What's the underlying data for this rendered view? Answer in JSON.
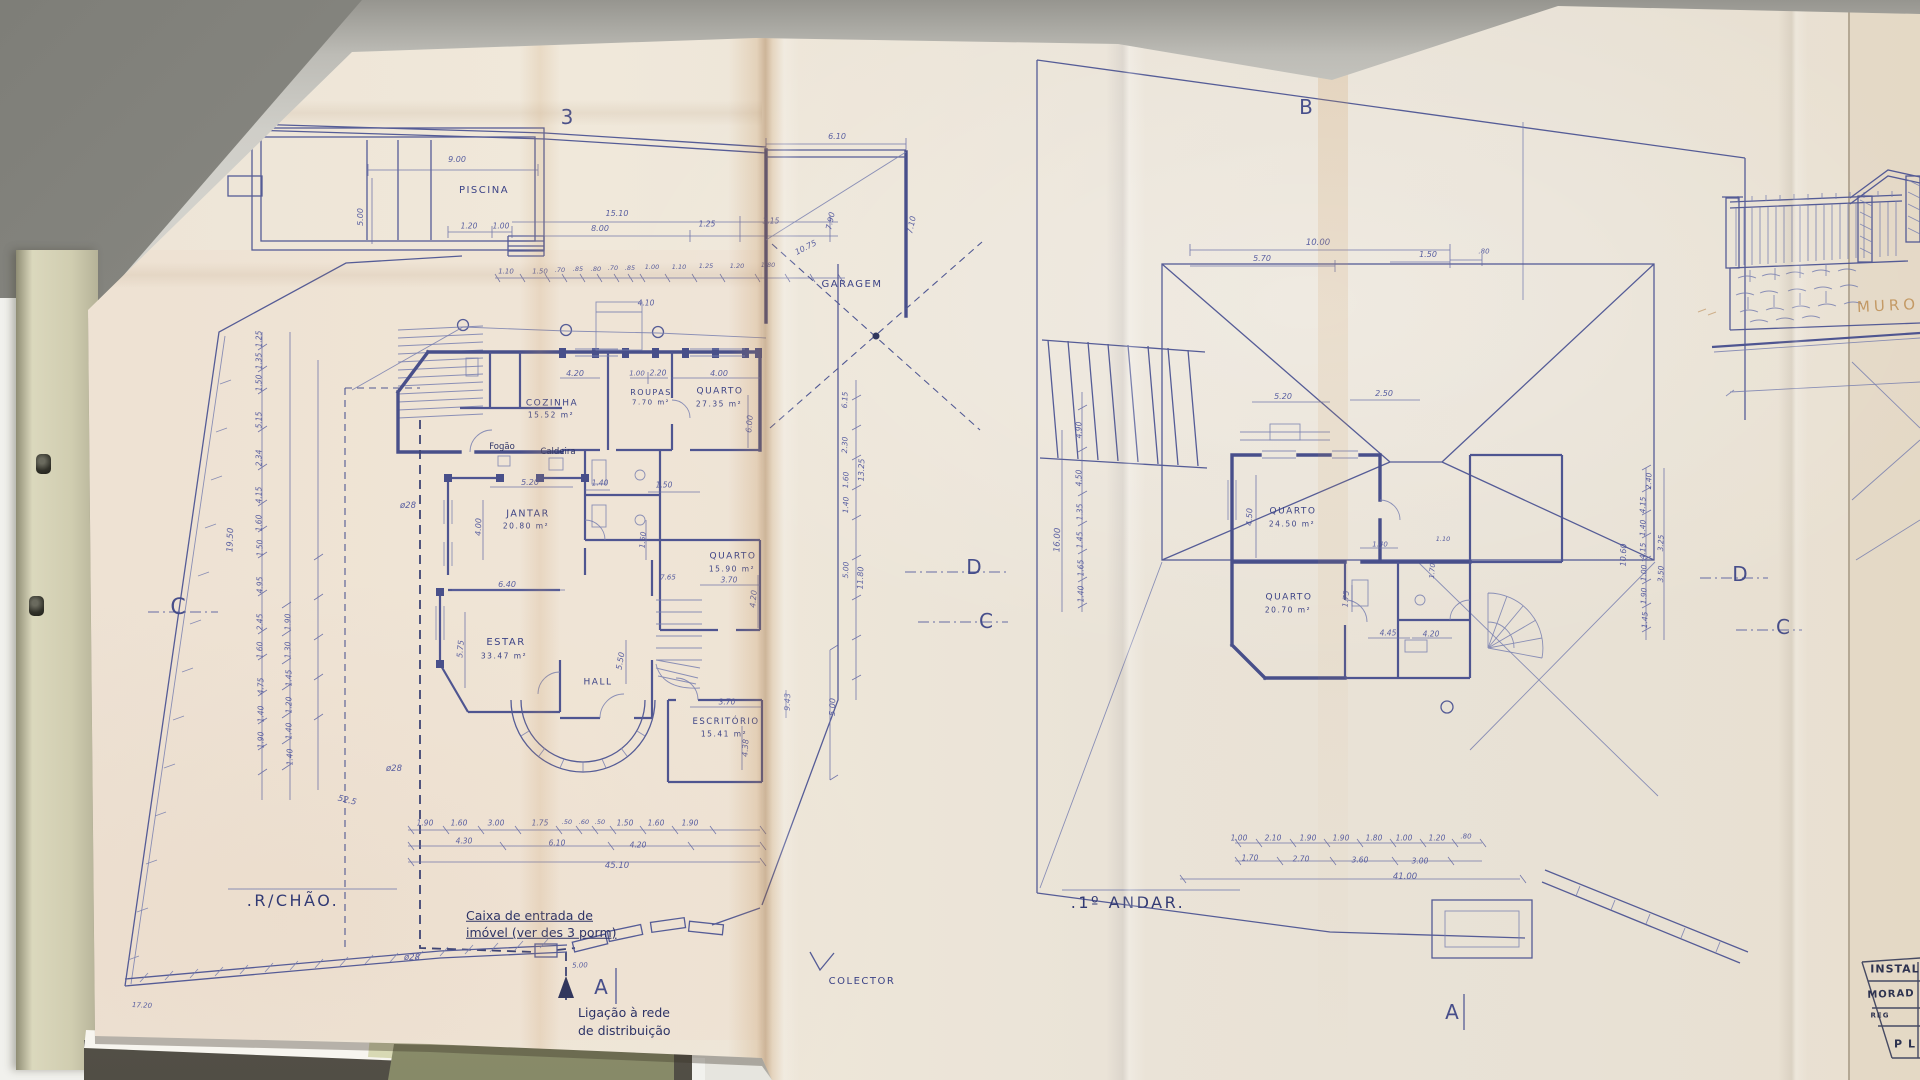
{
  "colors": {
    "ink": "#4a5292",
    "wall_ink": "#3c4485",
    "paper": "#ece4d6",
    "fold_tan": "#c08a50",
    "desk": "#d8d7d1",
    "folder": "#d0cdb0",
    "green_folder": "#989b76",
    "note_ink": "#2d3366",
    "pencil": "#bf9055"
  },
  "sheets": {
    "left_plan_title": ".R/CHÃO.",
    "right_plan_title": ".1º ANDAR.",
    "third_sheet": "title block + wall elevation (cut off)"
  },
  "labels": [
    {
      "n": "fold-number-3",
      "t": "3",
      "x": 567,
      "y": 117,
      "s": 20,
      "c": "big"
    },
    {
      "n": "section-letter-b",
      "t": "B",
      "x": 1306,
      "y": 107,
      "s": 20,
      "c": "big"
    },
    {
      "n": "section-letter-c-left",
      "t": "C",
      "x": 178,
      "y": 608,
      "s": 22,
      "c": "big"
    },
    {
      "n": "section-letter-d-mid",
      "t": "D",
      "x": 974,
      "y": 567,
      "s": 20,
      "c": "big"
    },
    {
      "n": "section-letter-c-mid",
      "t": "C",
      "x": 986,
      "y": 621,
      "s": 20,
      "c": "big"
    },
    {
      "n": "section-letter-d-right",
      "t": "D",
      "x": 1740,
      "y": 574,
      "s": 20,
      "c": "big"
    },
    {
      "n": "section-letter-c-right",
      "t": "C",
      "x": 1783,
      "y": 627,
      "s": 20,
      "c": "big"
    },
    {
      "n": "section-letter-a-left",
      "t": "A",
      "x": 601,
      "y": 987,
      "s": 20,
      "c": "big"
    },
    {
      "n": "section-letter-a-right",
      "t": "A",
      "x": 1452,
      "y": 1012,
      "s": 20,
      "c": "big"
    },
    {
      "n": "plan-title-ground-floor",
      "t": ".R/CHÃO.",
      "x": 293,
      "y": 901,
      "s": 16,
      "c": "title"
    },
    {
      "n": "plan-title-first-floor",
      "t": ".1º ANDAR.",
      "x": 1128,
      "y": 903,
      "s": 16,
      "c": "title"
    },
    {
      "n": "room-piscina",
      "t": "PISCINA",
      "x": 484,
      "y": 191,
      "s": 10,
      "c": "room"
    },
    {
      "n": "room-garagem",
      "t": "GARAGEM",
      "x": 852,
      "y": 285,
      "s": 10,
      "c": "room"
    },
    {
      "n": "room-cozinha",
      "t": "COZINHA",
      "x": 552,
      "y": 404,
      "s": 9,
      "c": "room"
    },
    {
      "n": "room-cozinha-area",
      "t": "15.52 m²",
      "x": 551,
      "y": 415,
      "s": 7.5,
      "c": "room"
    },
    {
      "n": "label-fogao",
      "t": "Fogão",
      "x": 502,
      "y": 447,
      "s": 8.5,
      "c": "note"
    },
    {
      "n": "label-caldeira",
      "t": "Caldeira",
      "x": 558,
      "y": 452,
      "s": 8.5,
      "c": "note"
    },
    {
      "n": "room-roupas",
      "t": "ROUPAS",
      "x": 651,
      "y": 393,
      "s": 8,
      "c": "room"
    },
    {
      "n": "room-roupas-area",
      "t": "7.70 m²",
      "x": 651,
      "y": 403,
      "s": 7,
      "c": "room"
    },
    {
      "n": "room-quarto-1",
      "t": "QUARTO",
      "x": 720,
      "y": 392,
      "s": 9,
      "c": "room"
    },
    {
      "n": "room-quarto-1-area",
      "t": "27.35 m²",
      "x": 719,
      "y": 404,
      "s": 7.5,
      "c": "room"
    },
    {
      "n": "room-jantar",
      "t": "JANTAR",
      "x": 528,
      "y": 514,
      "s": 9.5,
      "c": "room"
    },
    {
      "n": "room-jantar-area",
      "t": "20.80 m²",
      "x": 526,
      "y": 526,
      "s": 7.5,
      "c": "room"
    },
    {
      "n": "room-estar",
      "t": "ESTAR",
      "x": 506,
      "y": 643,
      "s": 10,
      "c": "room"
    },
    {
      "n": "room-estar-area",
      "t": "33.47 m²",
      "x": 504,
      "y": 656,
      "s": 7.5,
      "c": "room"
    },
    {
      "n": "room-hall",
      "t": "HALL",
      "x": 598,
      "y": 683,
      "s": 9,
      "c": "room"
    },
    {
      "n": "room-quarto-2",
      "t": "QUARTO",
      "x": 733,
      "y": 557,
      "s": 9,
      "c": "room"
    },
    {
      "n": "room-quarto-2-area",
      "t": "15.90 m²",
      "x": 732,
      "y": 569,
      "s": 7.5,
      "c": "room"
    },
    {
      "n": "room-escritorio",
      "t": "ESCRITÓRIO",
      "x": 726,
      "y": 722,
      "s": 8.5,
      "c": "room"
    },
    {
      "n": "room-escritorio-area",
      "t": "15.41 m²",
      "x": 724,
      "y": 734,
      "s": 7.5,
      "c": "room"
    },
    {
      "n": "room-ff-quarto-1",
      "t": "QUARTO",
      "x": 1293,
      "y": 512,
      "s": 9,
      "c": "room"
    },
    {
      "n": "room-ff-quarto-1-area",
      "t": "24.50 m²",
      "x": 1292,
      "y": 524,
      "s": 7.5,
      "c": "room"
    },
    {
      "n": "room-ff-quarto-2",
      "t": "QUARTO",
      "x": 1289,
      "y": 598,
      "s": 9,
      "c": "room"
    },
    {
      "n": "room-ff-quarto-2-area",
      "t": "20.70 m²",
      "x": 1288,
      "y": 610,
      "s": 7.5,
      "c": "room"
    },
    {
      "n": "label-colector",
      "t": "COLECTOR",
      "x": 862,
      "y": 982,
      "s": 10,
      "c": "room"
    },
    {
      "n": "note-caixa-line1",
      "t": "Caixa de entrada de",
      "x": 466,
      "y": 916,
      "s": 12.5,
      "c": "note",
      "a": "l",
      "u": 1
    },
    {
      "n": "note-caixa-line2",
      "t": "imóvel (ver des 3 porm)",
      "x": 466,
      "y": 933,
      "s": 12.5,
      "c": "note",
      "a": "l",
      "u": 1
    },
    {
      "n": "note-ligacao-line1",
      "t": "Ligação à rede",
      "x": 578,
      "y": 1013,
      "s": 12.5,
      "c": "note",
      "a": "l"
    },
    {
      "n": "note-ligacao-line2",
      "t": "de distribuição",
      "x": 578,
      "y": 1031,
      "s": 12.5,
      "c": "note",
      "a": "l"
    },
    {
      "n": "label-muro",
      "t": "MURO",
      "x": 1888,
      "y": 306,
      "s": 15,
      "c": "pencil",
      "r": -3,
      "ls": 4
    },
    {
      "n": "title-block-instal",
      "t": "INSTAL",
      "x": 1895,
      "y": 969,
      "s": 11,
      "c": "tb"
    },
    {
      "n": "title-block-morad",
      "t": "MORAD",
      "x": 1891,
      "y": 995,
      "s": 10,
      "c": "tb",
      "r": -2
    },
    {
      "n": "title-block-reg",
      "t": "REG",
      "x": 1880,
      "y": 1016,
      "s": 7,
      "c": "tb"
    },
    {
      "n": "title-block-pl",
      "t": "P L",
      "x": 1905,
      "y": 1044,
      "s": 11,
      "c": "tb"
    },
    {
      "n": "pipe-diameter",
      "t": "ø28",
      "x": 408,
      "y": 506,
      "s": 8.5
    },
    {
      "n": "pipe-diameter",
      "t": "ø28",
      "x": 394,
      "y": 769,
      "s": 8.5
    },
    {
      "n": "pipe-diameter",
      "t": "ø28",
      "x": 412,
      "y": 958,
      "s": 8.5
    },
    {
      "t": "52.5",
      "x": 347,
      "y": 801,
      "s": 8.5,
      "r": 14
    },
    {
      "t": "17.20",
      "x": 142,
      "y": 1006,
      "s": 7,
      "r": 3
    },
    {
      "t": "5.00",
      "x": 580,
      "y": 966,
      "s": 7,
      "r": -2
    },
    {
      "t": "9.00",
      "x": 457,
      "y": 160,
      "s": 8
    },
    {
      "t": "5.00",
      "x": 361,
      "y": 217,
      "s": 8,
      "r": -90
    },
    {
      "t": "1.20",
      "x": 469,
      "y": 226,
      "s": 7.5
    },
    {
      "t": "1.00",
      "x": 501,
      "y": 226,
      "s": 7.5
    },
    {
      "t": "15.10",
      "x": 617,
      "y": 214,
      "s": 8
    },
    {
      "t": "8.00",
      "x": 600,
      "y": 229,
      "s": 8
    },
    {
      "t": "1.25",
      "x": 707,
      "y": 224,
      "s": 7.5
    },
    {
      "t": "3.15",
      "x": 771,
      "y": 221,
      "s": 7.5
    },
    {
      "t": "6.10",
      "x": 837,
      "y": 137,
      "s": 8
    },
    {
      "t": "1.10",
      "x": 506,
      "y": 272,
      "s": 7
    },
    {
      "t": "1.50",
      "x": 540,
      "y": 272,
      "s": 7
    },
    {
      "t": ".70",
      "x": 560,
      "y": 270,
      "s": 6.5
    },
    {
      "t": ".85",
      "x": 578,
      "y": 269,
      "s": 6.5
    },
    {
      "t": ".80",
      "x": 596,
      "y": 269,
      "s": 6.5
    },
    {
      "t": ".70",
      "x": 613,
      "y": 268,
      "s": 6.5
    },
    {
      "t": ".85",
      "x": 630,
      "y": 268,
      "s": 6.5
    },
    {
      "t": "1.00",
      "x": 652,
      "y": 267,
      "s": 6.5
    },
    {
      "t": "1.10",
      "x": 679,
      "y": 267,
      "s": 6.5
    },
    {
      "t": "1.25",
      "x": 706,
      "y": 266,
      "s": 6.5
    },
    {
      "t": "1.20",
      "x": 737,
      "y": 266,
      "s": 6.5
    },
    {
      "t": "1.80",
      "x": 768,
      "y": 265,
      "s": 6.5
    },
    {
      "t": "10.75",
      "x": 806,
      "y": 248,
      "s": 8,
      "r": -27
    },
    {
      "t": "7.90",
      "x": 831,
      "y": 221,
      "s": 8,
      "r": -78
    },
    {
      "t": "7.10",
      "x": 912,
      "y": 225,
      "s": 8,
      "r": -78
    },
    {
      "t": "4.10",
      "x": 646,
      "y": 303,
      "s": 7.5
    },
    {
      "t": "1.00",
      "x": 637,
      "y": 374,
      "s": 7
    },
    {
      "t": "2.20",
      "x": 658,
      "y": 373,
      "s": 7.5
    },
    {
      "t": "4.00",
      "x": 719,
      "y": 374,
      "s": 8
    },
    {
      "t": "6.00",
      "x": 750,
      "y": 424,
      "s": 8,
      "r": -85
    },
    {
      "t": "4.20",
      "x": 575,
      "y": 374,
      "s": 8
    },
    {
      "t": "5.20",
      "x": 530,
      "y": 483,
      "s": 8
    },
    {
      "t": "1.40",
      "x": 600,
      "y": 483,
      "s": 7.5
    },
    {
      "t": "1.50",
      "x": 664,
      "y": 485,
      "s": 7.5
    },
    {
      "t": "4.00",
      "x": 479,
      "y": 527,
      "s": 8,
      "r": -88
    },
    {
      "t": "6.40",
      "x": 507,
      "y": 585,
      "s": 8
    },
    {
      "t": "5.75",
      "x": 461,
      "y": 649,
      "s": 8,
      "r": -85
    },
    {
      "t": "5.50",
      "x": 621,
      "y": 661,
      "s": 8,
      "r": -80
    },
    {
      "t": "1.50",
      "x": 643,
      "y": 540,
      "s": 7.5,
      "r": -85
    },
    {
      "t": "7.65",
      "x": 668,
      "y": 578,
      "s": 7
    },
    {
      "t": "3.70",
      "x": 729,
      "y": 580,
      "s": 7.5
    },
    {
      "t": "4.20",
      "x": 754,
      "y": 599,
      "s": 8,
      "r": -85
    },
    {
      "t": "3.70",
      "x": 727,
      "y": 702,
      "s": 7.5
    },
    {
      "t": "4.38",
      "x": 746,
      "y": 748,
      "s": 8,
      "r": -87
    },
    {
      "t": "9.43",
      "x": 788,
      "y": 702,
      "s": 8,
      "r": -88
    },
    {
      "t": "5.00",
      "x": 833,
      "y": 707,
      "s": 8,
      "r": -88
    },
    {
      "t": "1.25",
      "x": 259,
      "y": 339,
      "s": 7.5,
      "r": -90
    },
    {
      "t": "1.35",
      "x": 259,
      "y": 361,
      "s": 7.5,
      "r": -90
    },
    {
      "t": "1.50",
      "x": 259,
      "y": 383,
      "s": 7.5,
      "r": -90
    },
    {
      "t": "5.15",
      "x": 259,
      "y": 420,
      "s": 7.5,
      "r": -90
    },
    {
      "t": "2.34",
      "x": 259,
      "y": 458,
      "s": 7.5,
      "r": -90
    },
    {
      "t": "4.15",
      "x": 259,
      "y": 495,
      "s": 7.5,
      "r": -90
    },
    {
      "t": "1.60",
      "x": 259,
      "y": 523,
      "s": 7.5,
      "r": -90
    },
    {
      "t": "1.50",
      "x": 260,
      "y": 548,
      "s": 7.5,
      "r": -90
    },
    {
      "t": "4.95",
      "x": 260,
      "y": 585,
      "s": 7.5,
      "r": -90
    },
    {
      "t": "2.45",
      "x": 260,
      "y": 622,
      "s": 7.5,
      "r": -90
    },
    {
      "t": "1.60",
      "x": 260,
      "y": 650,
      "s": 7.5,
      "r": -90
    },
    {
      "t": "4.75",
      "x": 261,
      "y": 686,
      "s": 7.5,
      "r": -90
    },
    {
      "t": "1.40",
      "x": 261,
      "y": 714,
      "s": 7.5,
      "r": -90
    },
    {
      "t": "1.90",
      "x": 261,
      "y": 740,
      "s": 7.5,
      "r": -90
    },
    {
      "t": "19.50",
      "x": 231,
      "y": 540,
      "s": 8.5,
      "r": -88
    },
    {
      "t": "1.90",
      "x": 288,
      "y": 622,
      "s": 7.5,
      "r": -90
    },
    {
      "t": "1.30",
      "x": 288,
      "y": 650,
      "s": 7.5,
      "r": -90
    },
    {
      "t": "1.45",
      "x": 289,
      "y": 678,
      "s": 7.5,
      "r": -90
    },
    {
      "t": "1.20",
      "x": 289,
      "y": 705,
      "s": 7.5,
      "r": -90
    },
    {
      "t": "1.40",
      "x": 289,
      "y": 731,
      "s": 7.5,
      "r": -90
    },
    {
      "t": "1.40",
      "x": 290,
      "y": 757,
      "s": 7.5,
      "r": -90
    },
    {
      "t": "6.15",
      "x": 845,
      "y": 400,
      "s": 7.5,
      "r": -88
    },
    {
      "t": "2.30",
      "x": 845,
      "y": 445,
      "s": 7.5,
      "r": -88
    },
    {
      "t": "1.60",
      "x": 846,
      "y": 480,
      "s": 7.5,
      "r": -88
    },
    {
      "t": "1.40",
      "x": 846,
      "y": 505,
      "s": 7.5,
      "r": -88
    },
    {
      "t": "13.25",
      "x": 862,
      "y": 470,
      "s": 8,
      "r": -88
    },
    {
      "t": "5.00",
      "x": 846,
      "y": 570,
      "s": 7.5,
      "r": -88
    },
    {
      "t": "11.80",
      "x": 861,
      "y": 578,
      "s": 8,
      "r": -88
    },
    {
      "t": "1.90",
      "x": 425,
      "y": 823,
      "s": 7.5
    },
    {
      "t": "1.60",
      "x": 459,
      "y": 823,
      "s": 7.5
    },
    {
      "t": "3.00",
      "x": 496,
      "y": 823,
      "s": 7.5
    },
    {
      "t": "1.75",
      "x": 540,
      "y": 823,
      "s": 7.5
    },
    {
      "t": ".50",
      "x": 567,
      "y": 822,
      "s": 6.5
    },
    {
      "t": ".60",
      "x": 584,
      "y": 822,
      "s": 6.5
    },
    {
      "t": ".50",
      "x": 600,
      "y": 822,
      "s": 6.5
    },
    {
      "t": "1.50",
      "x": 625,
      "y": 823,
      "s": 7.5
    },
    {
      "t": "1.60",
      "x": 656,
      "y": 823,
      "s": 7.5
    },
    {
      "t": "1.90",
      "x": 690,
      "y": 823,
      "s": 7.5
    },
    {
      "t": "4.30",
      "x": 464,
      "y": 841,
      "s": 7.5
    },
    {
      "t": "6.10",
      "x": 557,
      "y": 843,
      "s": 7.5
    },
    {
      "t": "4.20",
      "x": 638,
      "y": 845,
      "s": 7.5
    },
    {
      "t": "45.10",
      "x": 617,
      "y": 866,
      "s": 8.5
    },
    {
      "t": "10.00",
      "x": 1318,
      "y": 243,
      "s": 8.5
    },
    {
      "t": "5.70",
      "x": 1262,
      "y": 259,
      "s": 8
    },
    {
      "t": "1.50",
      "x": 1428,
      "y": 255,
      "s": 8
    },
    {
      "t": ".80",
      "x": 1484,
      "y": 252,
      "s": 7
    },
    {
      "t": "4.90",
      "x": 1079,
      "y": 430,
      "s": 7.5,
      "r": -90
    },
    {
      "t": "4.50",
      "x": 1079,
      "y": 478,
      "s": 7.5,
      "r": -90
    },
    {
      "t": "1.35",
      "x": 1080,
      "y": 512,
      "s": 7.5,
      "r": -90
    },
    {
      "t": "1.45",
      "x": 1080,
      "y": 540,
      "s": 7.5,
      "r": -90
    },
    {
      "t": "1.65",
      "x": 1081,
      "y": 568,
      "s": 7.5,
      "r": -90
    },
    {
      "t": "1.40",
      "x": 1081,
      "y": 594,
      "s": 7.5,
      "r": -90
    },
    {
      "t": "16.00",
      "x": 1058,
      "y": 540,
      "s": 8.5,
      "r": -88
    },
    {
      "t": "5.20",
      "x": 1283,
      "y": 397,
      "s": 8
    },
    {
      "t": "2.50",
      "x": 1384,
      "y": 394,
      "s": 8
    },
    {
      "t": "4.50",
      "x": 1250,
      "y": 517,
      "s": 8,
      "r": -88
    },
    {
      "t": "1.40",
      "x": 1380,
      "y": 545,
      "s": 7
    },
    {
      "t": "1.75",
      "x": 1346,
      "y": 599,
      "s": 7.5,
      "r": -85
    },
    {
      "t": "4.45",
      "x": 1388,
      "y": 633,
      "s": 7.5
    },
    {
      "t": "4.20",
      "x": 1431,
      "y": 634,
      "s": 7.5
    },
    {
      "t": "1.10",
      "x": 1443,
      "y": 539,
      "s": 6.5
    },
    {
      "t": "1.70",
      "x": 1433,
      "y": 571,
      "s": 7,
      "r": -85
    },
    {
      "t": "2.40",
      "x": 1649,
      "y": 481,
      "s": 7.5,
      "r": -88
    },
    {
      "t": "4.15",
      "x": 1643,
      "y": 505,
      "s": 7.5,
      "r": -88
    },
    {
      "t": "1.40",
      "x": 1643,
      "y": 528,
      "s": 7.5,
      "r": -88
    },
    {
      "t": "4.15",
      "x": 1643,
      "y": 551,
      "s": 7.5,
      "r": -88
    },
    {
      "t": "1.00",
      "x": 1644,
      "y": 573,
      "s": 7.5,
      "r": -88
    },
    {
      "t": "1.90",
      "x": 1644,
      "y": 596,
      "s": 7.5,
      "r": -88
    },
    {
      "t": "1.45",
      "x": 1645,
      "y": 620,
      "s": 7.5,
      "r": -88
    },
    {
      "t": "3.25",
      "x": 1661,
      "y": 543,
      "s": 7.5,
      "r": -88
    },
    {
      "t": "3.50",
      "x": 1661,
      "y": 574,
      "s": 7.5,
      "r": -88
    },
    {
      "t": "10.60",
      "x": 1624,
      "y": 555,
      "s": 8,
      "r": -88
    },
    {
      "t": "1.00",
      "x": 1239,
      "y": 838,
      "s": 7.5
    },
    {
      "t": "2.10",
      "x": 1273,
      "y": 838,
      "s": 7.5
    },
    {
      "t": "1.90",
      "x": 1308,
      "y": 838,
      "s": 7.5
    },
    {
      "t": "1.90",
      "x": 1341,
      "y": 838,
      "s": 7.5
    },
    {
      "t": "1.80",
      "x": 1374,
      "y": 838,
      "s": 7.5
    },
    {
      "t": "1.00",
      "x": 1404,
      "y": 838,
      "s": 7.5
    },
    {
      "t": "1.20",
      "x": 1437,
      "y": 838,
      "s": 7.5
    },
    {
      "t": ".80",
      "x": 1466,
      "y": 837,
      "s": 7
    },
    {
      "t": "1.70",
      "x": 1250,
      "y": 858,
      "s": 7.5
    },
    {
      "t": "2.70",
      "x": 1301,
      "y": 859,
      "s": 7.5
    },
    {
      "t": "3.60",
      "x": 1360,
      "y": 860,
      "s": 7.5
    },
    {
      "t": "3.00",
      "x": 1420,
      "y": 861,
      "s": 7.5
    },
    {
      "t": "41.00",
      "x": 1405,
      "y": 877,
      "s": 8.5
    }
  ]
}
